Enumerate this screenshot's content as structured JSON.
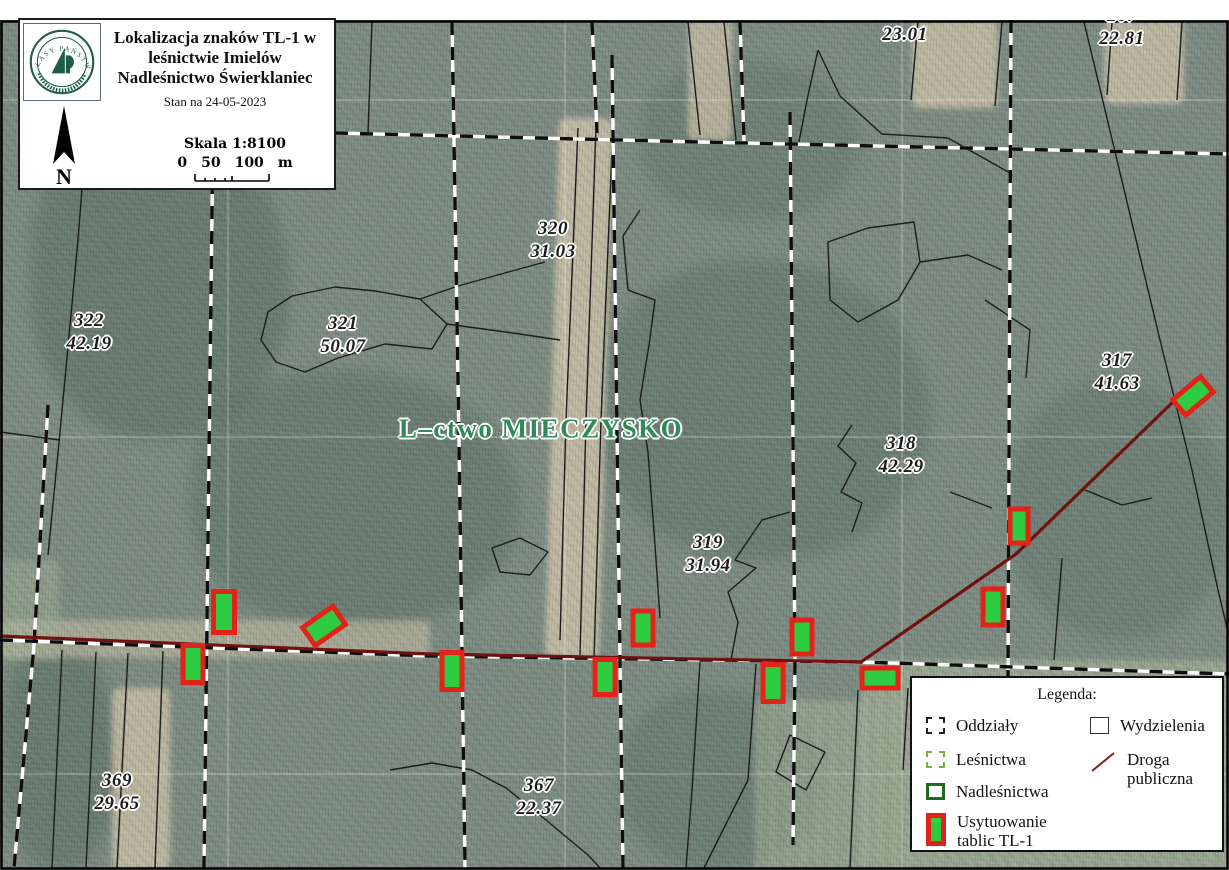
{
  "title_box": {
    "logo": {
      "organization": "LASY PAŃSTWOWE",
      "icon": "state-forests-emblem"
    },
    "title_lines": [
      "Lokalizacja znaków TL-1 w",
      "leśnictwie Imielów",
      "Nadleśnictwo Świerklaniec"
    ],
    "status_line": "Stan na 24-05-2023",
    "north_label": "N",
    "scale_label": "Skala 1:8100",
    "scale_bar": {
      "ticks": [
        "0",
        "50",
        "100"
      ],
      "unit": "m"
    }
  },
  "map": {
    "forestry_label": "L–ctwo MIECZYSKO",
    "compartments": [
      {
        "number": "266",
        "area": "23.01",
        "x": 905,
        "y": 23
      },
      {
        "number": "267",
        "area": "22.81",
        "x": 1122,
        "y": 27
      },
      {
        "number": "322",
        "area": "42.19",
        "x": 89,
        "y": 332
      },
      {
        "number": "321",
        "area": "50.07",
        "x": 343,
        "y": 335
      },
      {
        "number": "320",
        "area": "31.03",
        "x": 553,
        "y": 240
      },
      {
        "number": "317",
        "area": "41.63",
        "x": 1117,
        "y": 372
      },
      {
        "number": "318",
        "area": "42.29",
        "x": 901,
        "y": 455
      },
      {
        "number": "319",
        "area": "31.94",
        "x": 708,
        "y": 554
      },
      {
        "number": "369",
        "area": "29.65",
        "x": 117,
        "y": 792
      },
      {
        "number": "367",
        "area": "22.37",
        "x": 539,
        "y": 797
      }
    ],
    "tl1_markers": [
      {
        "x": 224,
        "y": 612,
        "w": 21,
        "h": 41,
        "rot": 0
      },
      {
        "x": 324,
        "y": 626,
        "w": 37,
        "h": 22,
        "rot": -35
      },
      {
        "x": 193,
        "y": 664,
        "w": 20,
        "h": 37,
        "rot": 0
      },
      {
        "x": 452,
        "y": 671,
        "w": 20,
        "h": 37,
        "rot": 0
      },
      {
        "x": 643,
        "y": 628,
        "w": 20,
        "h": 34,
        "rot": 0
      },
      {
        "x": 605,
        "y": 677,
        "w": 20,
        "h": 35,
        "rot": 0
      },
      {
        "x": 802,
        "y": 637,
        "w": 20,
        "h": 34,
        "rot": 0
      },
      {
        "x": 773,
        "y": 683,
        "w": 20,
        "h": 37,
        "rot": 0
      },
      {
        "x": 880,
        "y": 678,
        "w": 36,
        "h": 20,
        "rot": 0
      },
      {
        "x": 993,
        "y": 607,
        "w": 20,
        "h": 36,
        "rot": 0
      },
      {
        "x": 1019,
        "y": 526,
        "w": 18,
        "h": 34,
        "rot": 0
      },
      {
        "x": 1193,
        "y": 396,
        "w": 36,
        "h": 20,
        "rot": -40
      }
    ]
  },
  "legend": {
    "title": "Legenda:",
    "items": [
      {
        "label": "Oddziały",
        "symbol": "black-dashed-square"
      },
      {
        "label": "Leśnictwa",
        "symbol": "green-dashed-square"
      },
      {
        "label": "Nadleśnictwa",
        "symbol": "dark-green-square"
      },
      {
        "label": "Usytuowanie tablic TL-1",
        "symbol": "green-rect-red-border"
      },
      {
        "label": "Wydzielenia",
        "symbol": "black-square"
      },
      {
        "label": "Droga publiczna",
        "symbol": "dark-red-line"
      }
    ]
  },
  "colors": {
    "tl1_fill": "#2ecc40",
    "tl1_border": "#e2231a",
    "road": "#701111",
    "lesnictwa_green": "#76b043",
    "nadlesnictwa_green": "#1d6b1d",
    "forestry_label_green": "#2e8b57"
  }
}
